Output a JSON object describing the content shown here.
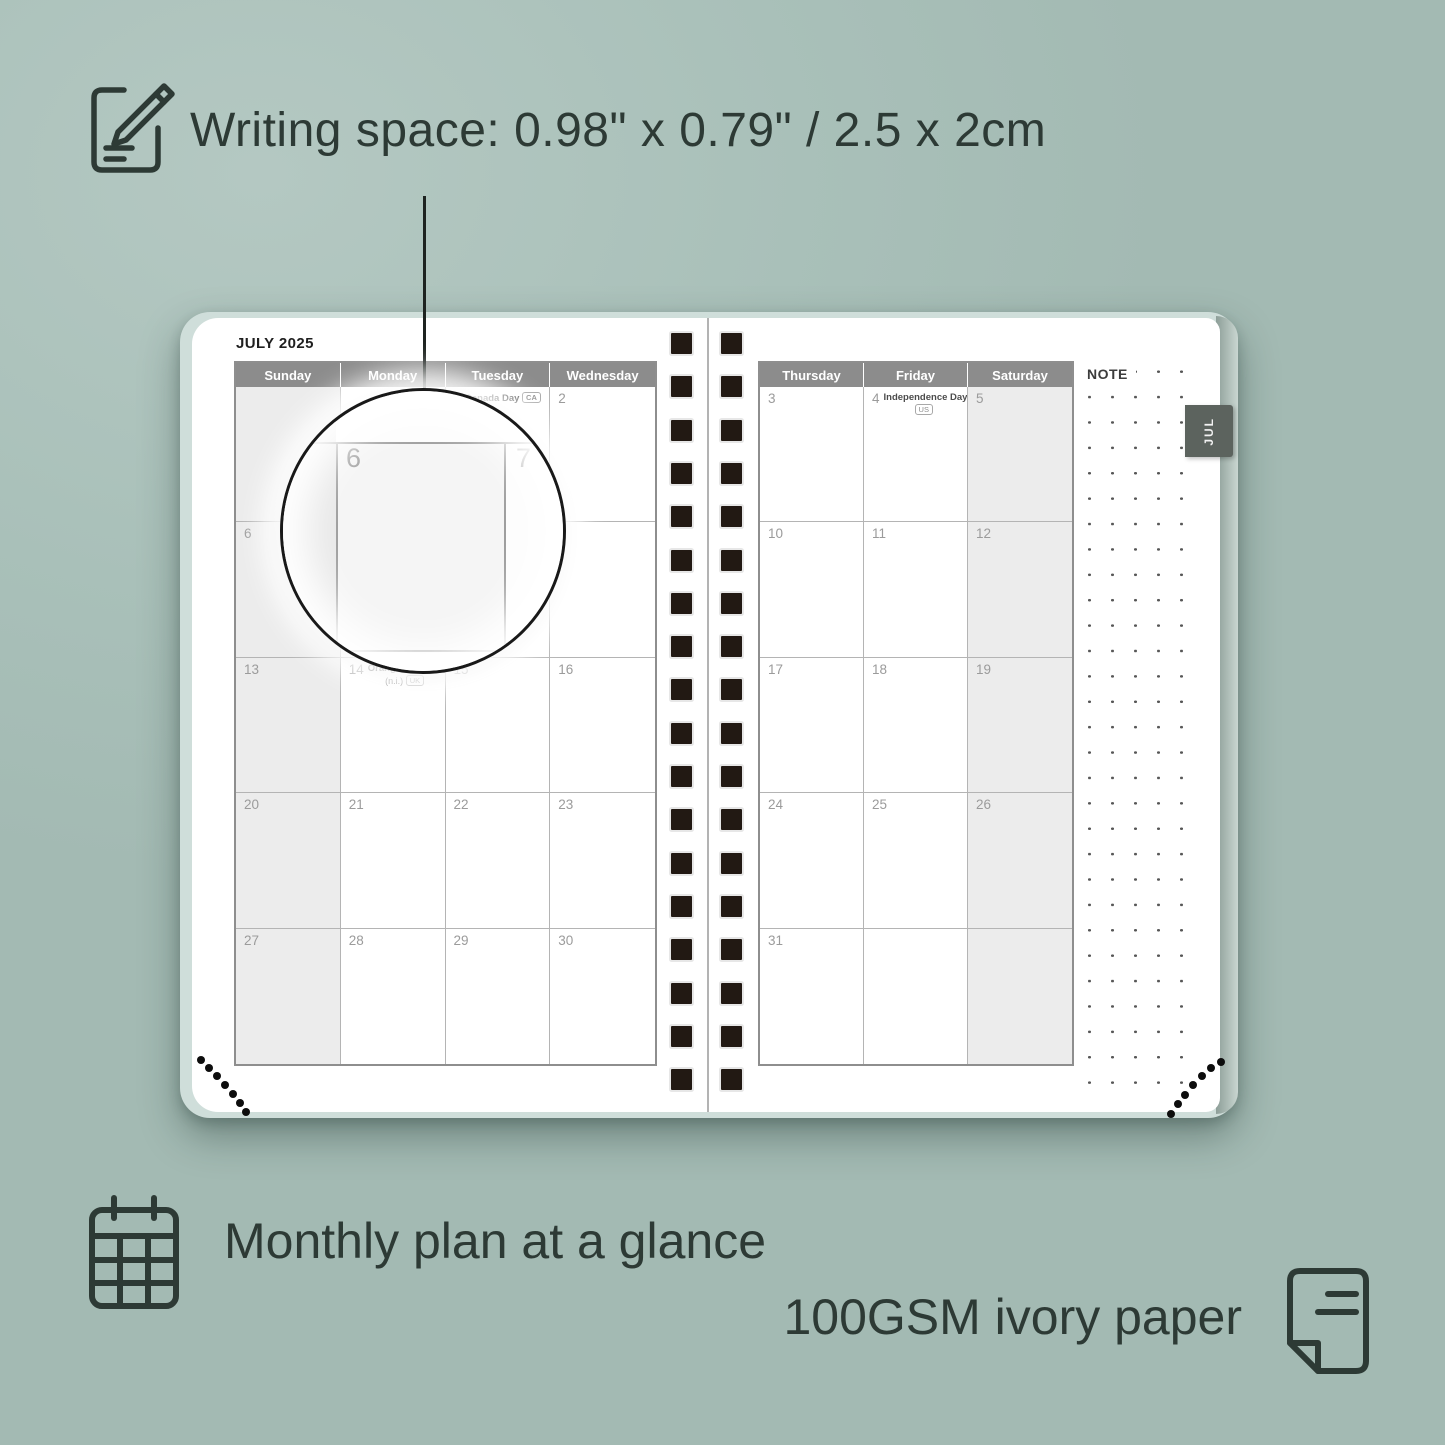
{
  "annotations": {
    "writing_space": "Writing space: 0.98\" x 0.79\" / 2.5 x 2cm",
    "monthly_plan": "Monthly plan at a glance",
    "paper": "100GSM ivory paper"
  },
  "planner": {
    "month_title": "JULY 2025",
    "tab_label": "JUL",
    "note_label": "NOTE",
    "left_headers": [
      "Sunday",
      "Monday",
      "Tuesday",
      "Wednesday"
    ],
    "right_headers": [
      "Thursday",
      "Friday",
      "Saturday"
    ],
    "left_shaded_col": 0,
    "right_shaded_col": 2,
    "left_weeks": [
      [
        {
          "day": ""
        },
        {
          "day": ""
        },
        {
          "day": "1",
          "holiday": "Canada Day",
          "badge": "CA",
          "badge_inline": true
        },
        {
          "day": "2"
        }
      ],
      [
        {
          "day": "6"
        },
        {
          "day": "7"
        },
        {
          "day": "8"
        },
        {
          "day": "9"
        }
      ],
      [
        {
          "day": "13"
        },
        {
          "day": "14",
          "holiday": "Orangemen's Day",
          "sub": "(n.i.)",
          "badge": "UK"
        },
        {
          "day": "15"
        },
        {
          "day": "16"
        }
      ],
      [
        {
          "day": "20"
        },
        {
          "day": "21"
        },
        {
          "day": "22"
        },
        {
          "day": "23"
        }
      ],
      [
        {
          "day": "27"
        },
        {
          "day": "28"
        },
        {
          "day": "29"
        },
        {
          "day": "30"
        }
      ]
    ],
    "right_weeks": [
      [
        {
          "day": "3"
        },
        {
          "day": "4",
          "holiday": "Independence Day",
          "badge": "US"
        },
        {
          "day": "5"
        }
      ],
      [
        {
          "day": "10"
        },
        {
          "day": "11"
        },
        {
          "day": "12"
        }
      ],
      [
        {
          "day": "17"
        },
        {
          "day": "18"
        },
        {
          "day": "19"
        }
      ],
      [
        {
          "day": "24"
        },
        {
          "day": "25"
        },
        {
          "day": "26"
        }
      ],
      [
        {
          "day": "31"
        },
        {
          "day": ""
        },
        {
          "day": ""
        }
      ]
    ]
  },
  "magnifier": {
    "day_a": "6",
    "day_b": "7"
  },
  "colors": {
    "background": "#a9c0b9",
    "text_dark": "#2d3a35",
    "header_gray": "#8c8c8c",
    "shaded_cell": "#ececec",
    "tab_gray": "#5c635e",
    "spiral_black": "#221913",
    "page_white": "#ffffff"
  }
}
